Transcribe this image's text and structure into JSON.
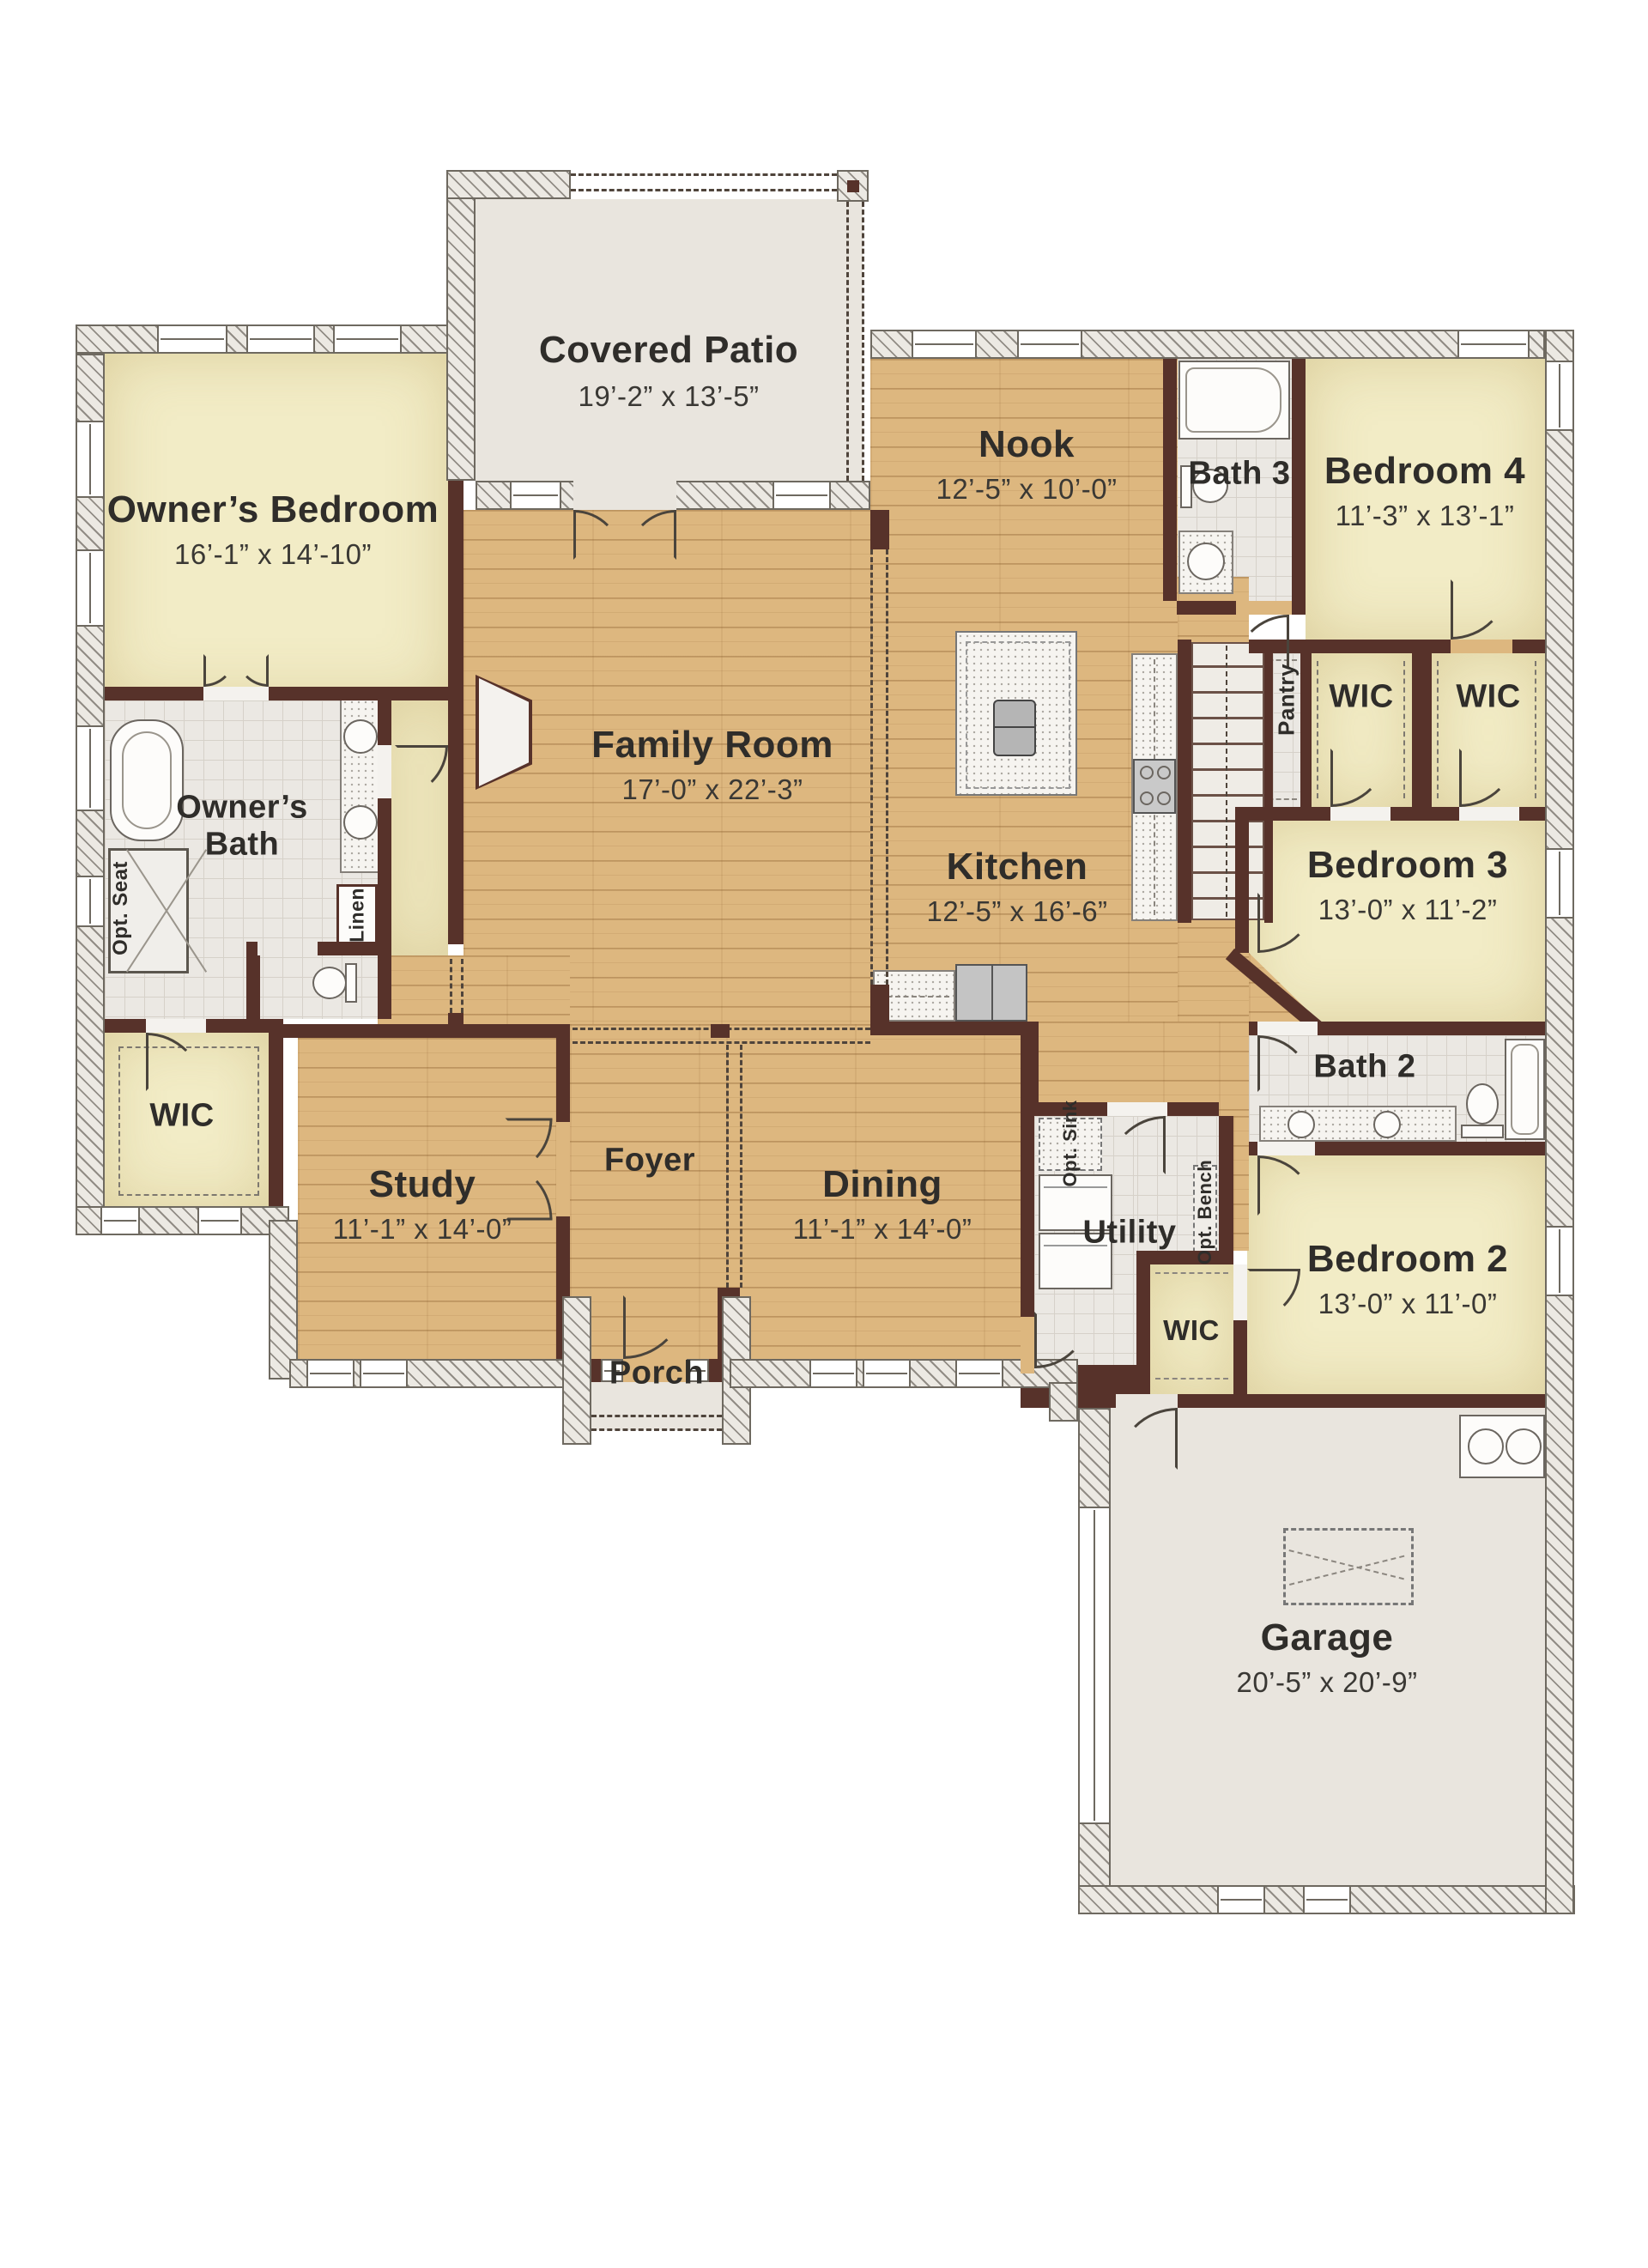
{
  "rooms": {
    "covered_patio": {
      "name": "Covered Patio",
      "dims": "19’-2” x 13’-5”"
    },
    "owners_bedroom": {
      "name": "Owner’s Bedroom",
      "dims": "16’-1” x 14’-10”"
    },
    "family_room": {
      "name": "Family Room",
      "dims": "17’-0” x 22’-3”"
    },
    "nook": {
      "name": "Nook",
      "dims": "12’-5” x 10’-0”"
    },
    "kitchen": {
      "name": "Kitchen",
      "dims": "12’-5” x 16’-6”"
    },
    "bath_3": {
      "name": "Bath 3"
    },
    "bedroom_4": {
      "name": "Bedroom 4",
      "dims": "11’-3” x 13’-1”"
    },
    "wic_bedroom4_left": {
      "name": "WIC"
    },
    "wic_bedroom4_right": {
      "name": "WIC"
    },
    "pantry": {
      "name": "Pantry"
    },
    "bedroom_3": {
      "name": "Bedroom 3",
      "dims": "13’-0” x 11’-2”"
    },
    "bath_2": {
      "name": "Bath 2"
    },
    "bedroom_2": {
      "name": "Bedroom 2",
      "dims": "13’-0” x 11’-0”"
    },
    "wic_bedroom2": {
      "name": "WIC"
    },
    "owners_bath": {
      "name": "Owner’s Bath"
    },
    "owners_wic": {
      "name": "WIC"
    },
    "study": {
      "name": "Study",
      "dims": "11’-1” x 14’-0”"
    },
    "foyer": {
      "name": "Foyer"
    },
    "dining": {
      "name": "Dining",
      "dims": "11’-1” x 14’-0”"
    },
    "utility": {
      "name": "Utility"
    },
    "porch": {
      "name": "Porch"
    },
    "garage": {
      "name": "Garage",
      "dims": "20’-5” x 20’-9”"
    }
  },
  "annotations": {
    "opt_seat": "Opt. Seat",
    "linen": "Linen",
    "opt_sink": "Opt. Sink",
    "opt_bench": "Opt. Bench"
  },
  "colors": {
    "wall": "#57322a",
    "wood_floor": "#ddb77f",
    "bedroom_floor": "#f2ecc6",
    "tile_floor": "#ebe8e3",
    "concrete_floor": "#e9e5de",
    "label_text": "#2f2d2a"
  }
}
